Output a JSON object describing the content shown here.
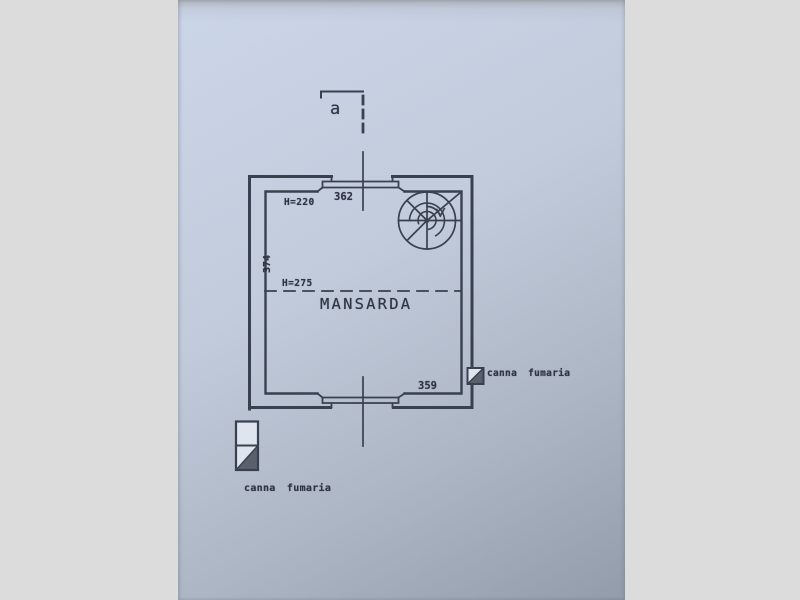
{
  "colors": {
    "letterbox": "#dcdcdd",
    "paper-light": "#ccd6e9",
    "paper-mid": "#c2cbdb",
    "paper-dark": "#929cab",
    "ink": "#39404f",
    "ink-text": "#2f3542",
    "fill-dark": "#5a606c",
    "fill-white": "#dfe5ee"
  },
  "plan": {
    "room_label": "MANSARDA",
    "section_marker": "a",
    "dim_top_width": "362",
    "dim_left_height": "374",
    "dim_bottom_width": "359",
    "height_label_low": "H=220",
    "height_label_high": "H=275",
    "flue_label_right": "canna fumaria",
    "legend_label": "canna fumaria",
    "symbols": {
      "spiral_staircase": "spiral-staircase-icon",
      "flue": "canna-fumaria-flue-icon",
      "section_cut": "section-cut-line"
    }
  }
}
